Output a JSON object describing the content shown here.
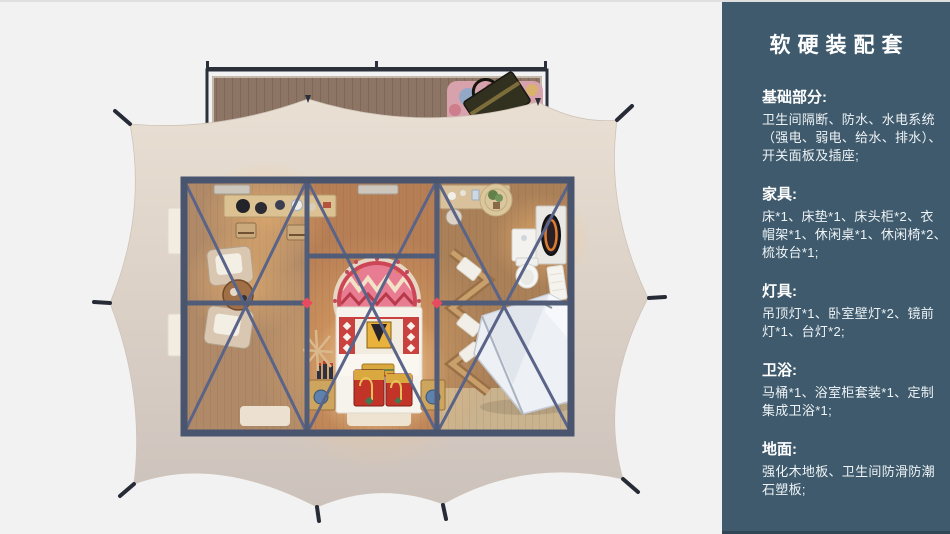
{
  "page": {
    "background": "#f2f2f3",
    "type_note": "product presentation slide: top-down render of glamping tent suite + furnishing spec panel"
  },
  "sidebar": {
    "background": "#3e5a6c",
    "title": "软硬装配套",
    "sections": [
      {
        "heading": "基础部分:",
        "body_lines": [
          "卫生间隔断、防水、水电系统",
          "（强电、弱电、给水、排水）、",
          "开关面板及插座;"
        ]
      },
      {
        "heading": "家具:",
        "body_lines": [
          "床*1、床垫*1、床头柜*2、衣",
          "帽架*1、休闲桌*1、休闲椅*2、",
          "梳妆台*1;"
        ]
      },
      {
        "heading": "灯具:",
        "body_lines": [
          "吊顶灯*1、卧室壁灯*2、镜前",
          "灯*1、台灯*2;"
        ]
      },
      {
        "heading": "卫浴:",
        "body_lines": [
          "马桶*1、浴室柜套装*1、定制",
          "集成卫浴*1;"
        ]
      },
      {
        "heading": "地面:",
        "body_lines": [
          "强化木地板、卫生间防滑防潮",
          "石塑板;"
        ]
      }
    ]
  },
  "floorplan": {
    "objects": [
      "wood-deck",
      "deck-rug",
      "travel-bag",
      "tent-canopy",
      "tent-stakes",
      "steel-frame",
      "ceiling-vents",
      "leisure-desk",
      "desk-chairs",
      "lounge-chairs",
      "side-table",
      "round-mandala-rug",
      "bed",
      "pillows",
      "red-trunk-chests",
      "nightstands",
      "table-lamps",
      "coat-rack",
      "vanity-desk",
      "plant-on-straw-rug",
      "dressing-table-mirror",
      "toilet",
      "towel-rack",
      "integrated-shower-unit",
      "floor-mats"
    ],
    "palette": {
      "canvas_bg": "#f2f2f3",
      "canopy": "#ddd2c7",
      "deck_wood": "#8d7565",
      "frame_steel": "#515c78",
      "floor_wood": "#b28a67",
      "rug_pink": "#e87c92",
      "bed_red": "#c8373f",
      "connector_red": "#e84b5f",
      "shower_white": "#edf0f4",
      "sidebar_teal": "#3e5a6c"
    }
  }
}
